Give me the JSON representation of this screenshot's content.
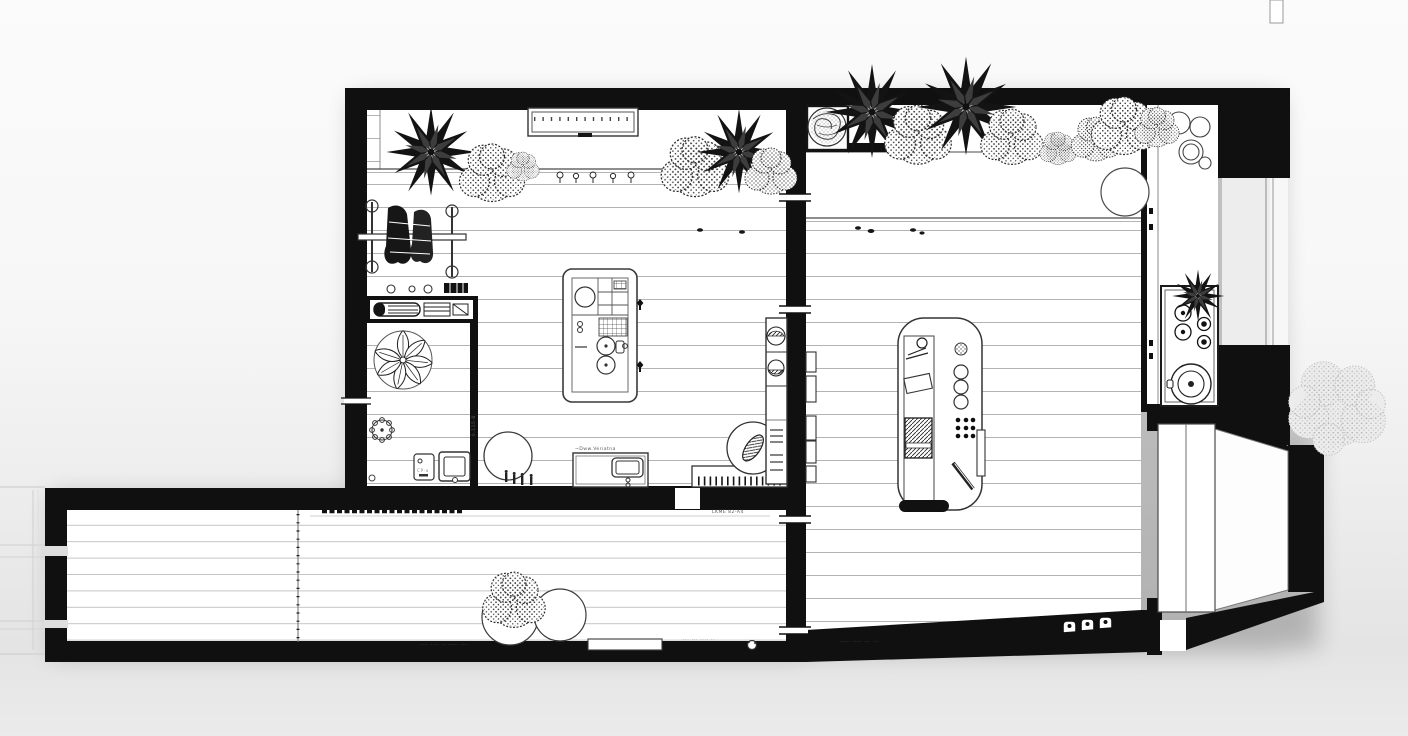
{
  "scene": {
    "description": "Monochrome top-down architectural floor plan of an apartment: left living room with kitchen island and bathroom nook, right studio room with curved desk, narrow kitchen strip with stove and round sink, entry vestibule with open door, and a long bottom terrace with plants"
  },
  "colors": {
    "ink": "#101010",
    "paper": "#ffffff",
    "line": "#3a3a3a",
    "plank": "#b3b3b3",
    "plank-light": "#c4c4c4",
    "faint": "#d4d4d4",
    "window": "#ededed",
    "soft-tree": "#ececec",
    "soft-tree-edge": "#bfbfbf"
  },
  "labels": {
    "basin_label": "~Dww.Veriatna",
    "wall_tag": "LKME  82-A4",
    "divider_tag": "0.115-B",
    "panel_label": "CP·a",
    "terrace_note_a": "·--· ---· ·- ··--· ---",
    "terrace_note_b": "·-- ··- --·· ·-",
    "room_note": "·--·· ---- ·-- ···"
  },
  "icons": {
    "spiky-plant": "black starburst palm seen from above",
    "bushy-plant": "stippled round shrub",
    "leafy-plant": "potted leaf rosette",
    "round-plant": "crackled sphere plant in planter box",
    "soft-tree": "pale exterior tree canopy",
    "outlet-marker": "small black diamond"
  }
}
